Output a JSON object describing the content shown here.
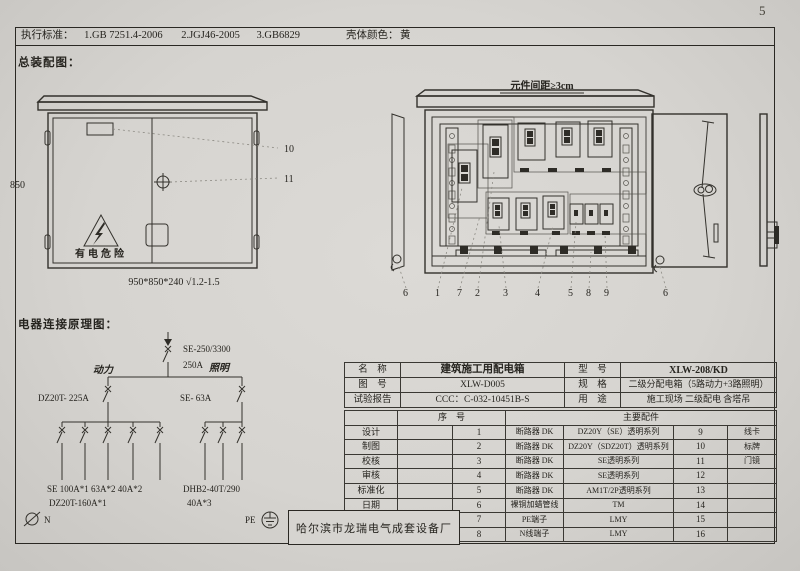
{
  "page": {
    "number": "5"
  },
  "header": {
    "label": "执行标准：",
    "standards": [
      "1.GB 7251.4-2006",
      "2.JGJ46-2005",
      "3.GB6829"
    ],
    "shell_color_label": "壳体颜色：",
    "shell_color": "黄"
  },
  "assembly": {
    "title": "总装配图：",
    "front_view": {
      "height_dim": "850",
      "size_note": "950*850*240 √1.2-1.5",
      "warning_text": "有电危险",
      "callout_vent": "10",
      "callout_handle": "11"
    },
    "open_view": {
      "spacing_note": "元件间距≥3cm",
      "callouts": [
        "6",
        "1",
        "7",
        "2",
        "3",
        "4",
        "5",
        "8",
        "9",
        "6"
      ]
    }
  },
  "wiring": {
    "title": "电器连接原理图：",
    "main_model": "SE-250/3300",
    "main_rating": "250A",
    "branch_power": "动力",
    "branch_lighting": "照明",
    "power_breaker": "DZ20T- 225A",
    "lighting_breaker": "SE- 63A",
    "power_outputs": "SE 100A*1  63A*2  40A*2",
    "power_outputs2": "DZ20T-160A*1",
    "lighting_outputs": "DHB2-40T/290",
    "lighting_outputs2": "40A*3",
    "neutral": "N",
    "pe": "PE"
  },
  "spec": {
    "info": [
      {
        "l1": "名　称",
        "v1": "建筑施工用配电箱",
        "l2": "型　号",
        "v2": "XLW-208/KD"
      },
      {
        "l1": "图　号",
        "v1": "XLW-D005",
        "l2": "规　格",
        "v2": "二级分配电箱（5路动力+3路照明）"
      },
      {
        "l1": "试验报告",
        "v1": "CCC：C-032-10451B-S",
        "l2": "用　途",
        "v2": "施工现场 二级配电 含塔吊"
      }
    ],
    "serial_header": "序　号",
    "parts_header": "主要配件",
    "sign_labels": [
      "设计",
      "制图",
      "校核",
      "审核",
      "标准化",
      "日期"
    ],
    "items": [
      {
        "no": "1",
        "part": "断路器 DK",
        "desc": "DZ20Y（SE）透明系列",
        "no2": "9",
        "part2": "线卡"
      },
      {
        "no": "2",
        "part": "断路器 DK",
        "desc": "DZ20Y（SDZ20T）透明系列",
        "no2": "10",
        "part2": "标牌"
      },
      {
        "no": "3",
        "part": "断路器 DK",
        "desc": "SE透明系列",
        "no2": "11",
        "part2": "门镜"
      },
      {
        "no": "4",
        "part": "断路器 DK",
        "desc": "SE透明系列",
        "no2": "12",
        "part2": ""
      },
      {
        "no": "5",
        "part": "断路器 DK",
        "desc": "AM1T/2P透明系列",
        "no2": "13",
        "part2": ""
      },
      {
        "no": "6",
        "part": "裸铜加蜡管线",
        "desc": "TM",
        "no2": "14",
        "part2": ""
      },
      {
        "no": "7",
        "part": "PE端子",
        "desc": "LMY",
        "no2": "15",
        "part2": ""
      },
      {
        "no": "8",
        "part": "N线端子",
        "desc": "LMY",
        "no2": "16",
        "part2": ""
      }
    ],
    "manufacturer": "哈尔滨市龙瑞电气成套设备厂"
  }
}
